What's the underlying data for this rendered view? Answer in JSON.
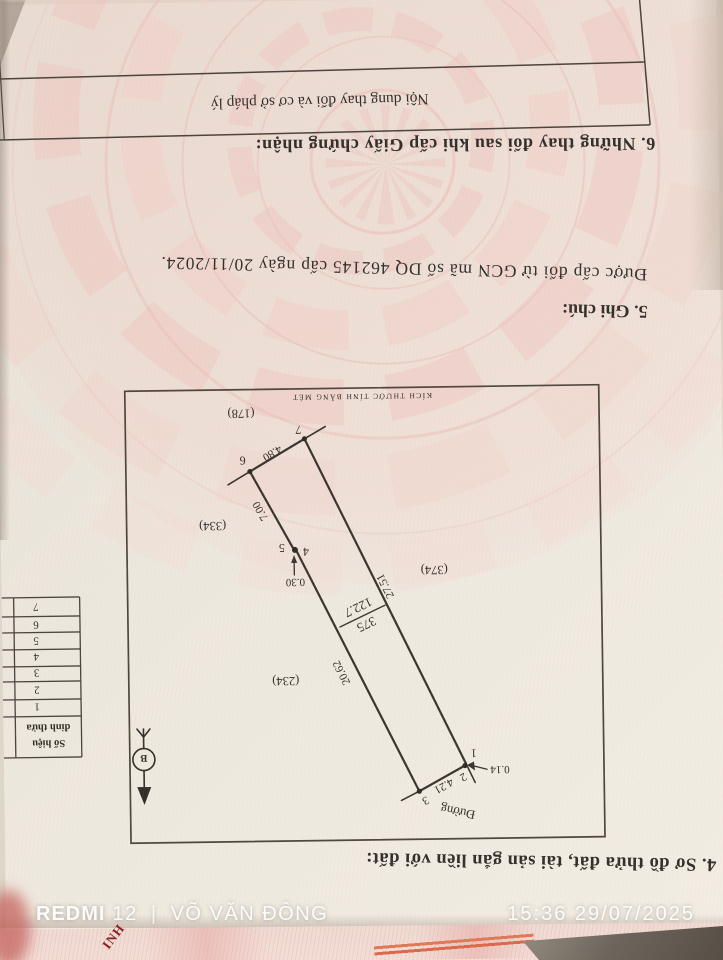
{
  "camera_overlay": {
    "device_bold": "REDMI",
    "device_rest": "12",
    "separator": "|",
    "owner": "VÕ VĂN ĐÔNG",
    "timestamp": "15:36 29/07/2025"
  },
  "page": {
    "section6": {
      "heading": "6. Những thay đổi sau khi cấp Giấy chứng nhận:",
      "col_header": "Nội dung thay đổi và cơ sở pháp lý"
    },
    "section5": {
      "heading": "5. Ghi chú:",
      "note": "Được cấp đổi từ GCN mã số DQ 462145 cấp ngày 20/11/2024."
    },
    "section4": {
      "heading": "4. Sơ đồ thửa đất, tài sản gắn liền với đất:"
    },
    "map": {
      "scale_note": "KÍCH THƯỚC TÍNH BẰNG MÉT",
      "road_label": "Đường",
      "north_label": "B",
      "parcel_number": "375",
      "parcel_area": "122.7",
      "neighbors": [
        "(178)",
        "(334)",
        "(374)",
        "(234)"
      ],
      "vertices": [
        "1",
        "2",
        "3",
        "4",
        "5",
        "6",
        "7"
      ],
      "edges": {
        "e23": "4.21",
        "e34": "20.62",
        "e56": "7.00",
        "e67": "4.80",
        "e71": "27.51",
        "d45": "0.30",
        "d12": "0.14"
      }
    },
    "vertex_table": {
      "header_line1": "Số hiệu",
      "header_line2": "đỉnh thửa",
      "rows": [
        "1",
        "2",
        "3",
        "4",
        "5",
        "6",
        "7"
      ]
    },
    "under_doc_text": "INH"
  }
}
